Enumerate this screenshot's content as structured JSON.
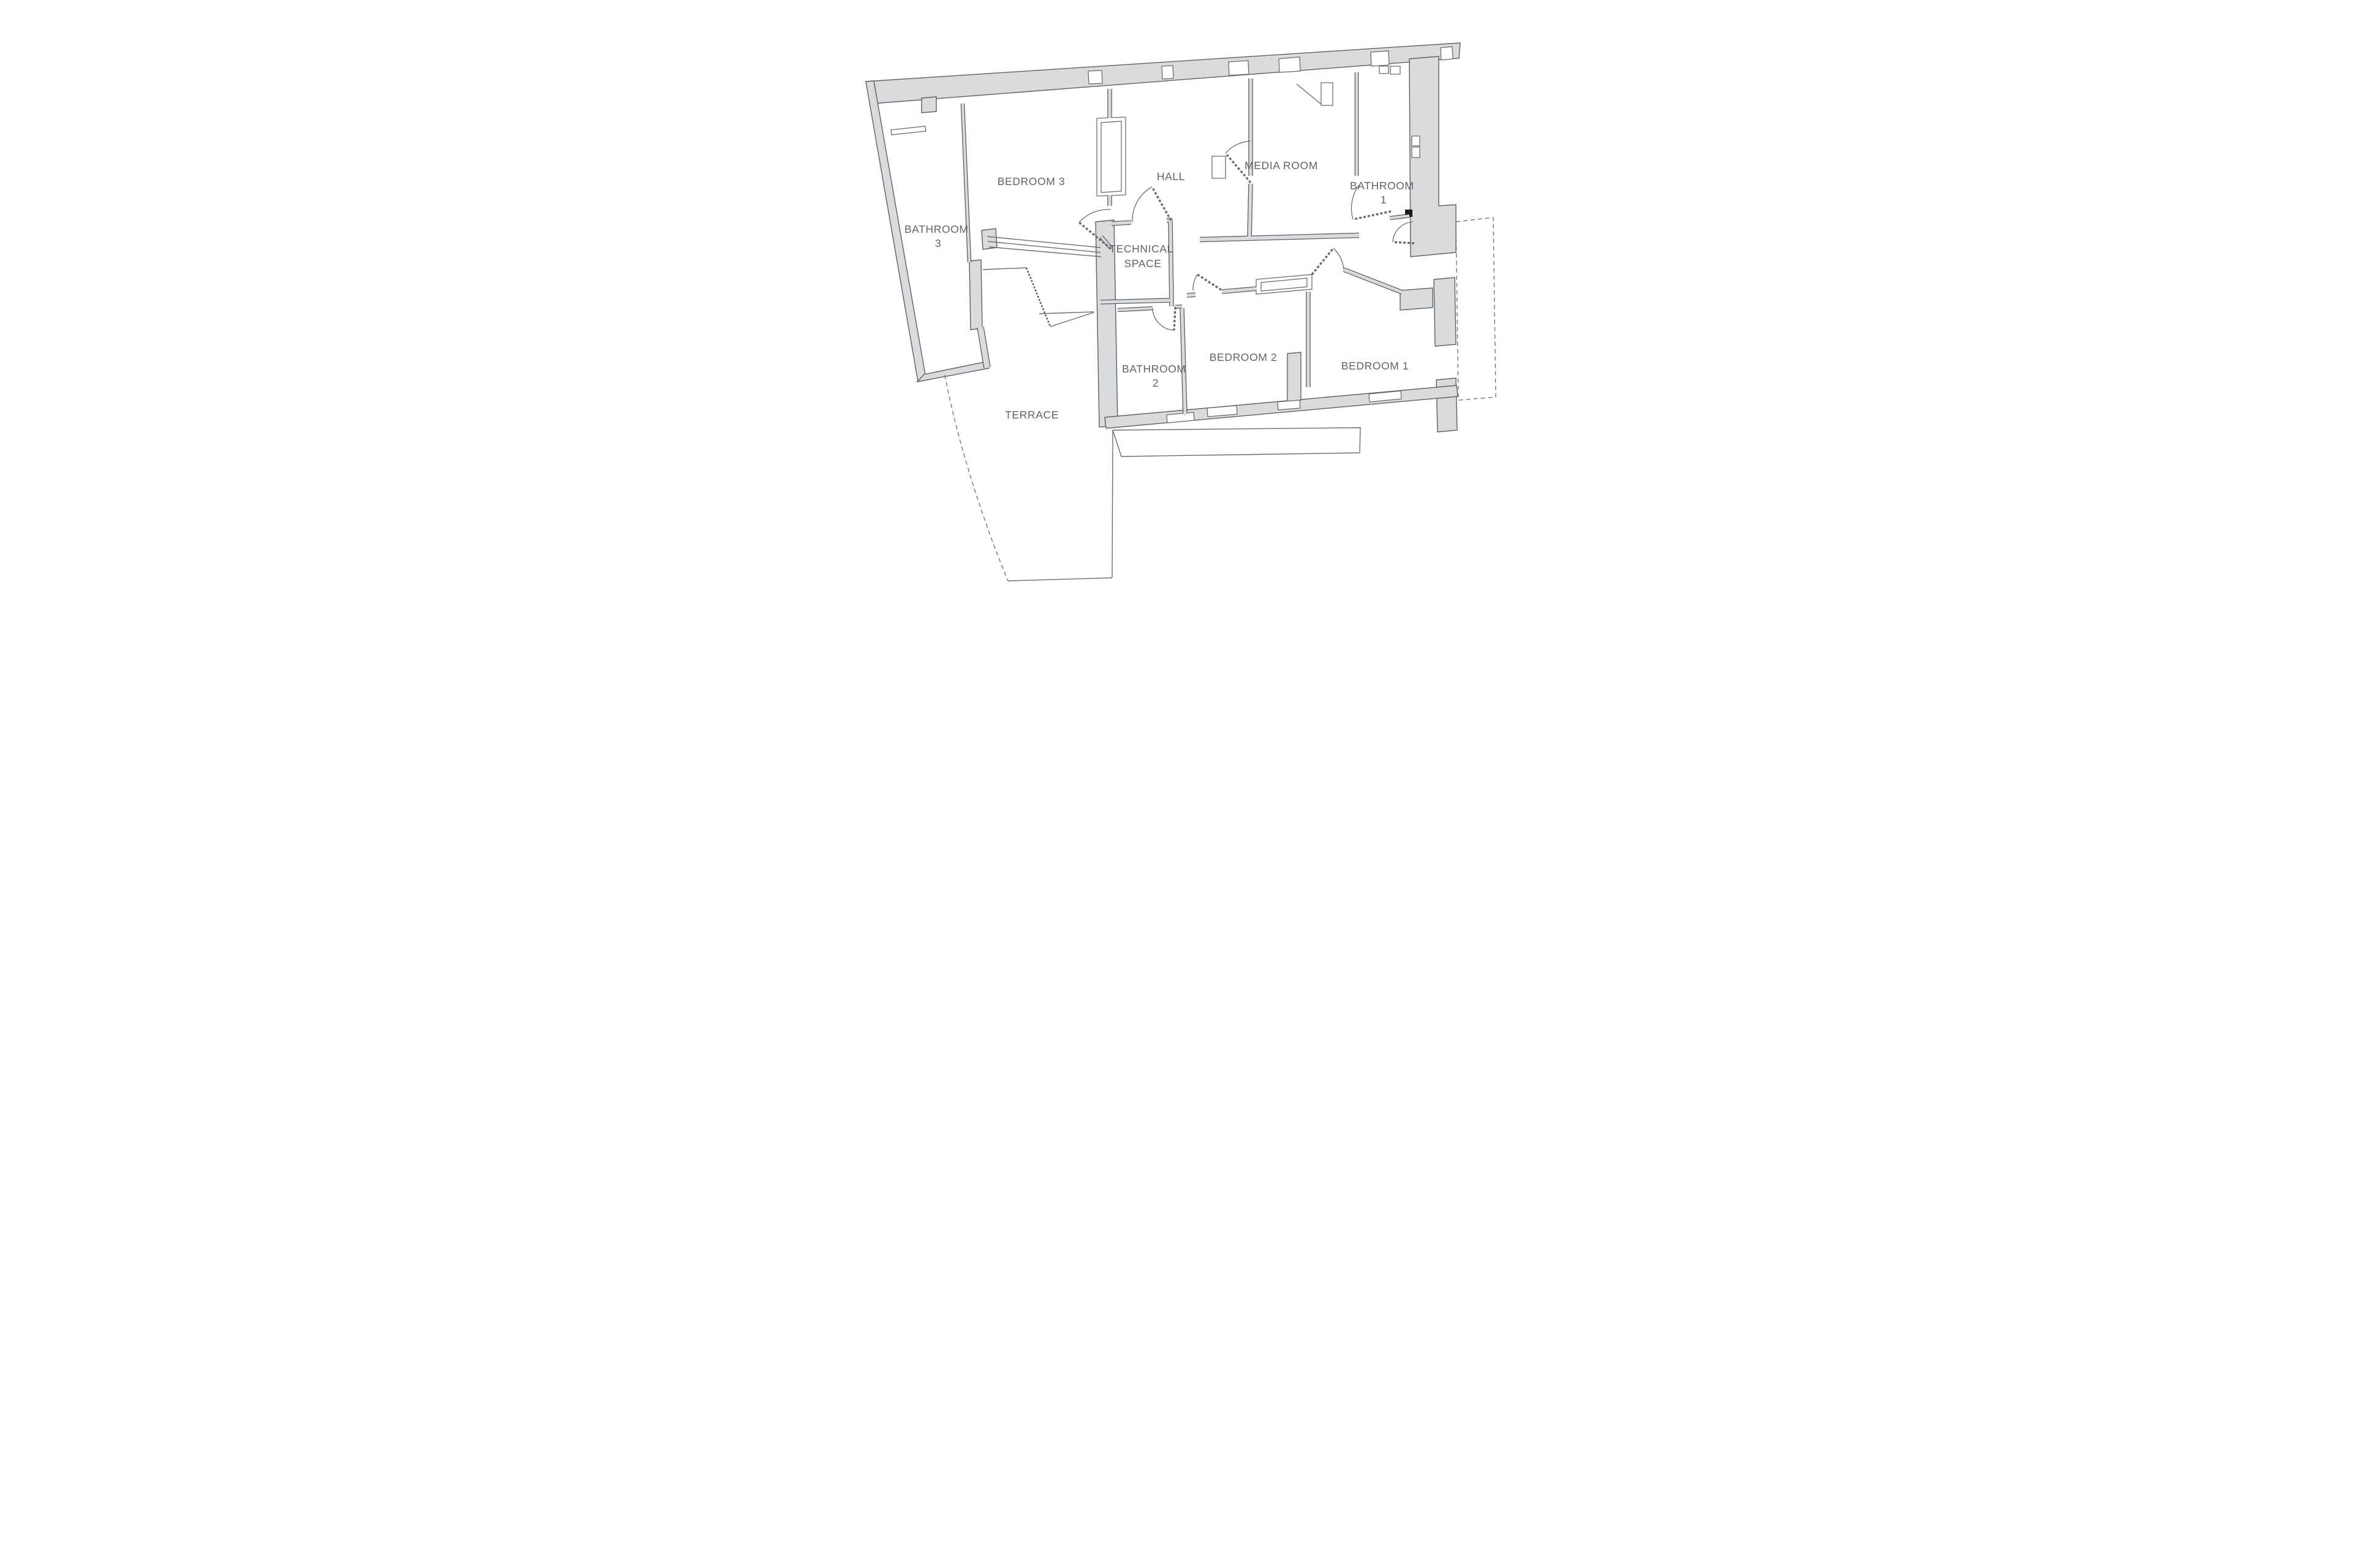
{
  "figure": {
    "kind": "architectural floor plan",
    "background": "#ffffff"
  },
  "colors": {
    "wall_fill": "#dadbdc",
    "wall_edge": "#5d6064",
    "line": "#6a6d70",
    "label_text": "#60646a"
  },
  "rooms": [
    {
      "id": "bedroom-3",
      "lines": [
        "BEDROOM 3"
      ]
    },
    {
      "id": "bathroom-3",
      "lines": [
        "BATHROOM",
        "3"
      ]
    },
    {
      "id": "hall",
      "lines": [
        "HALL"
      ]
    },
    {
      "id": "media-room",
      "lines": [
        "MEDIA ROOM"
      ]
    },
    {
      "id": "bathroom-1",
      "lines": [
        "BATHROOM",
        "1"
      ]
    },
    {
      "id": "technical-space",
      "lines": [
        "TECHNICAL",
        "SPACE"
      ]
    },
    {
      "id": "bathroom-2",
      "lines": [
        "BATHROOM",
        "2"
      ]
    },
    {
      "id": "bedroom-2",
      "lines": [
        "BEDROOM 2"
      ]
    },
    {
      "id": "bedroom-1",
      "lines": [
        "BEDROOM 1"
      ]
    },
    {
      "id": "terrace",
      "lines": [
        "TERRACE"
      ]
    }
  ]
}
